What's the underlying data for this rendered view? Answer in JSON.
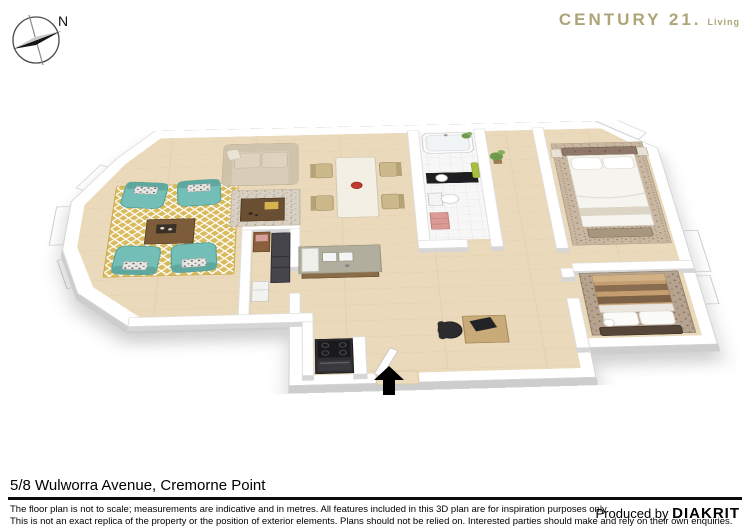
{
  "page": {
    "width": 750,
    "height": 530,
    "background": "#ffffff"
  },
  "compass": {
    "label": "N"
  },
  "logo": {
    "brand": "CENTURY 21.",
    "tagline": "Living",
    "color": "#ada577"
  },
  "floorplan": {
    "style": "3d-rendered-floor-plan",
    "entrance_arrow_direction": "up",
    "rooms": [
      "living-room",
      "sitting-area",
      "dining-area",
      "kitchen",
      "laundry-pantry",
      "bathroom",
      "hallway",
      "master-bedroom",
      "bedroom-2",
      "entrance"
    ],
    "furniture": [
      "teal-armchairs",
      "coffee-table",
      "yellow-patterned-rug",
      "sofa",
      "speckled-rug",
      "dining-table-with-chairs",
      "red-bowl",
      "kitchen-island-with-sink",
      "stove",
      "refrigerator",
      "laundry-cabinet",
      "bathtub",
      "black-vanity",
      "toilet",
      "pink-towels",
      "green-towel",
      "plant",
      "desk-with-office-chair",
      "double-bed",
      "bedside-tables",
      "bed-with-striped-duvet"
    ],
    "palette": {
      "wall": "#ffffff",
      "wall_shade": "#cdcdcd",
      "floor_wood": "#ead9ba",
      "floor_tile": "#f6f6f6",
      "rug_yellow": "#d9ba5c",
      "rug_beige": "#d8d0c2",
      "teal_chair": "#73beb6",
      "sofa_beige": "#d8cdb8",
      "wood_dark": "#6b4f33",
      "counter_gray": "#b2ae9d",
      "appliance_black": "#2e2e31",
      "bed_headboard": "#8e7668",
      "duvet_white": "#f6f4ef",
      "duvet_tan": "#c49e70",
      "accent_red": "#bf3b2b",
      "towel_pink": "#db9b94",
      "towel_green": "#a6bf3f",
      "plant_green": "#6f9a4d",
      "arrow": "#000000"
    }
  },
  "footer": {
    "address": "5/8 Wulworra Avenue, Cremorne Point",
    "disclaimer": [
      "The floor plan is not to scale; measurements are indicative and in metres. All features included in this 3D plan are for inspiration purposes only.",
      "This is not an exact replica of the property or the position of exterior elements. Plans should not be relied on. Interested parties should make and rely on their own enquiries."
    ],
    "produced_by_label": "Produced by",
    "producer": "DIAKRIT"
  }
}
